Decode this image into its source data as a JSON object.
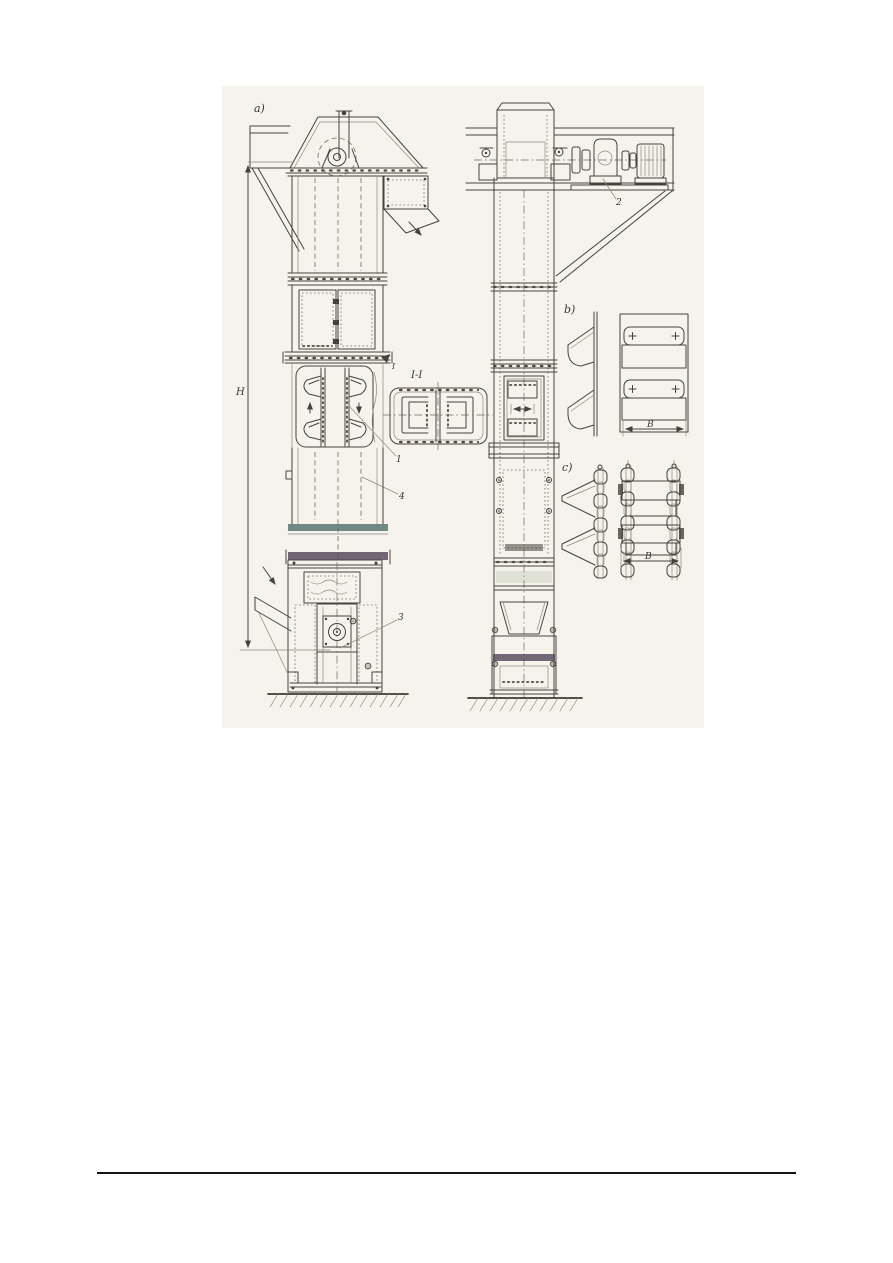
{
  "page": {
    "background": "#ffffff",
    "footer_rule_color": "#141414"
  },
  "drawing": {
    "labels": {
      "view_a": "a)",
      "view_b": "b)",
      "view_c": "c)",
      "section": "I-I",
      "section_cut": "I"
    },
    "parts": {
      "bucket": "1",
      "drive": "2",
      "take_up": "3",
      "casing": "4"
    },
    "dimensions": {
      "height": "H",
      "bucket_width_belt": "B",
      "bucket_width_chain": "B"
    },
    "colors": {
      "paper": "#f6f3ed",
      "ink": "#46423b",
      "band_teal": "#4c6a66",
      "band_purple": "#544559"
    }
  }
}
